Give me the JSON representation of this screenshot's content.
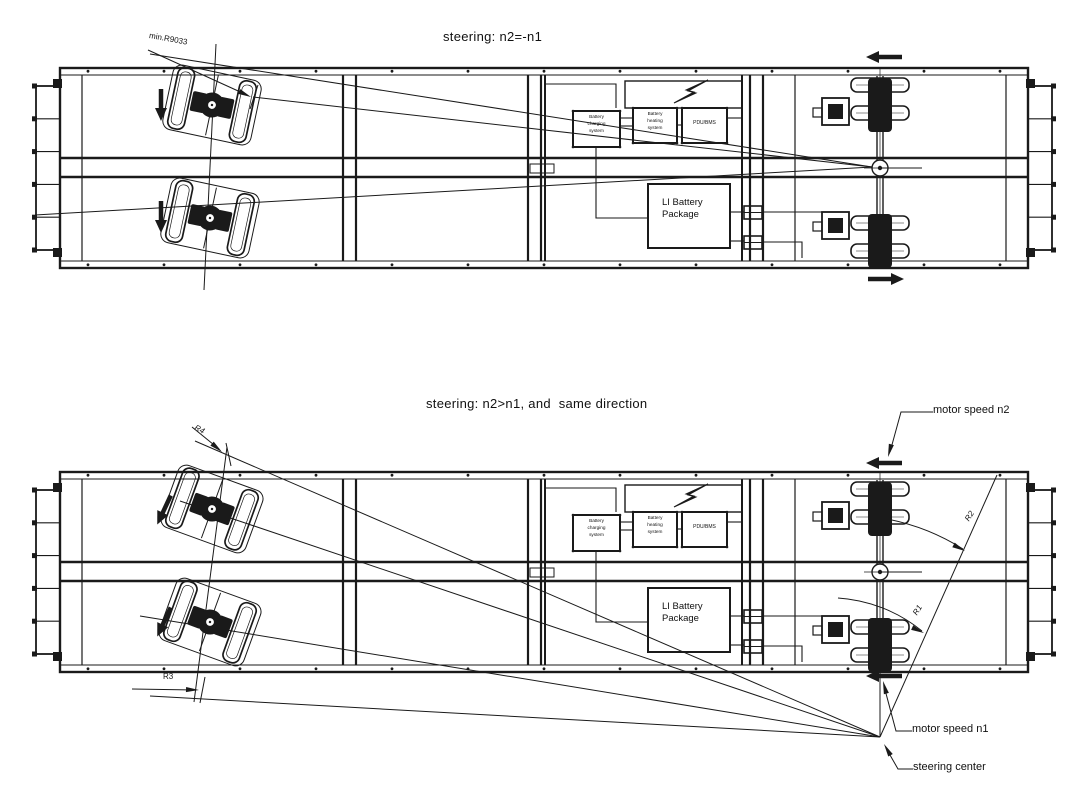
{
  "colors": {
    "ink": "#1a1a1a",
    "background": "#ffffff"
  },
  "diagram1": {
    "title": "steering: n2=-n1",
    "min_radius": "min.R9033"
  },
  "diagram2": {
    "title": "steering: n2>n1, and  same direction",
    "r1": "R1",
    "r2": "R2",
    "r3": "R3",
    "r4": "R4",
    "motor_speed_n2": "motor speed n2",
    "motor_speed_n1": "motor speed n1",
    "steering_center": "steering center"
  },
  "vehicle": {
    "battery_charging": "Battery\ncharging\nsystem",
    "battery_heating": "Battery\nheating\nsystem",
    "pdu_bms": "PDU/BMS",
    "li_battery": "LI Battery\nPackage"
  }
}
